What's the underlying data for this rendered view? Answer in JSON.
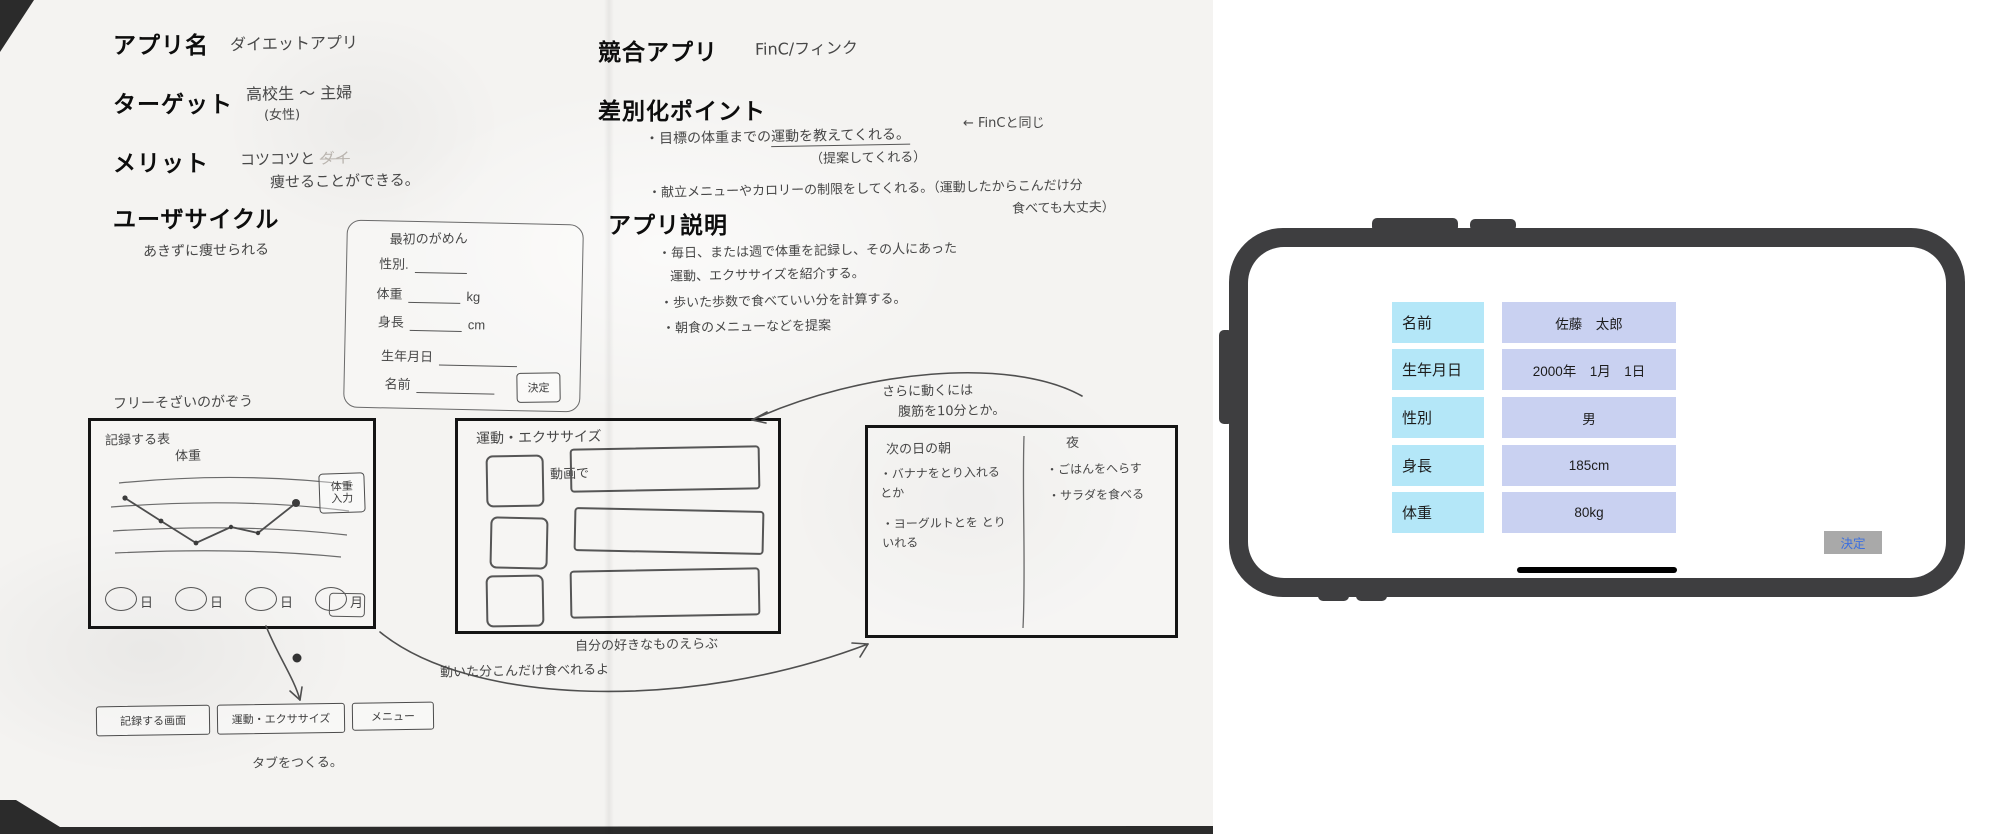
{
  "paper": {
    "app_name": {
      "label": "アプリ名",
      "value": "ダイエットアプリ"
    },
    "target": {
      "label": "ターゲット",
      "value": "高校生 〜 主婦",
      "note": "(女性)"
    },
    "merit": {
      "label": "メリット",
      "line1": "コツコツと",
      "erased": "ダイ",
      "line2": "痩せることができる。"
    },
    "user_cycle": {
      "label": "ユーザサイクル",
      "value": "あきずに痩せられる"
    },
    "competitor": {
      "label": "競合アプリ",
      "value": "FinC/フィンク"
    },
    "diff": {
      "label": "差別化ポイント",
      "b1_pre": "・目標の体重までの",
      "b1_underline": "運動を教えてくれる。",
      "b1_note": "（提案してくれる）",
      "b1_arrow": "← FinCと同じ",
      "b2": "・献立メニューやカロリーの制限をしてくれる。（運動したからこんだけ分",
      "b2_cont": "食べても大丈夫）"
    },
    "desc": {
      "label": "アプリ説明",
      "b1": "・毎日、または週で体重を記録し、その人にあった",
      "b1_cont": "運動、エクササイズを紹介する。",
      "b2": "・歩いた歩数で食べていい分を計算する。",
      "b3": "・朝食のメニューなどを提案"
    },
    "form_sketch": {
      "title": "最初のがめん",
      "fields": [
        {
          "label": "性別.",
          "unit": ""
        },
        {
          "label": "体重",
          "unit": "kg"
        },
        {
          "label": "身長",
          "unit": "cm"
        },
        {
          "label": "生年月日",
          "unit": ""
        },
        {
          "label": "名前",
          "unit": ""
        }
      ],
      "button": "決定"
    },
    "free_note": "フリーそざいのがぞう",
    "wf1": {
      "title": "記録する表",
      "subtitle": "体重",
      "button_line1": "体重",
      "button_line2": "入力",
      "ticks": [
        "日",
        "日",
        "日",
        "月"
      ]
    },
    "wf2": {
      "title": "運動・エクササイズ",
      "video_note": "動画で",
      "caption": "自分の好きなものえらぶ"
    },
    "wf3": {
      "note1": "さらに動くには",
      "note2": "腹筋を10分とか。",
      "morning": "次の日の朝",
      "night": "夜",
      "morning_items": [
        "・バナナをとり入れる とか",
        "・ヨーグルトとを とりいれる"
      ],
      "night_items": [
        "・ごはんをへらす",
        "・サラダを食べる"
      ]
    },
    "flow_note": "動いた分こんだけ食べれるよ",
    "tabbar": {
      "items": [
        "記録する画面",
        "運動・エクササイズ",
        "メニュー"
      ],
      "note": "タブをつくる。"
    }
  },
  "phone": {
    "form_rows": [
      {
        "label": "名前",
        "value": "佐藤　太郎"
      },
      {
        "label": "生年月日",
        "value": "2000年　1月　1日"
      },
      {
        "label": "性別",
        "value": "男"
      },
      {
        "label": "身長",
        "value": "185cm"
      },
      {
        "label": "体重",
        "value": "80kg"
      }
    ],
    "submit": "決定",
    "colors": {
      "frame": "#3e3e40",
      "label_bg": "#b4e7f8",
      "value_bg": "#c9d1f1",
      "button_bg": "#a9a9a9",
      "button_text": "#3b6fe0"
    }
  }
}
